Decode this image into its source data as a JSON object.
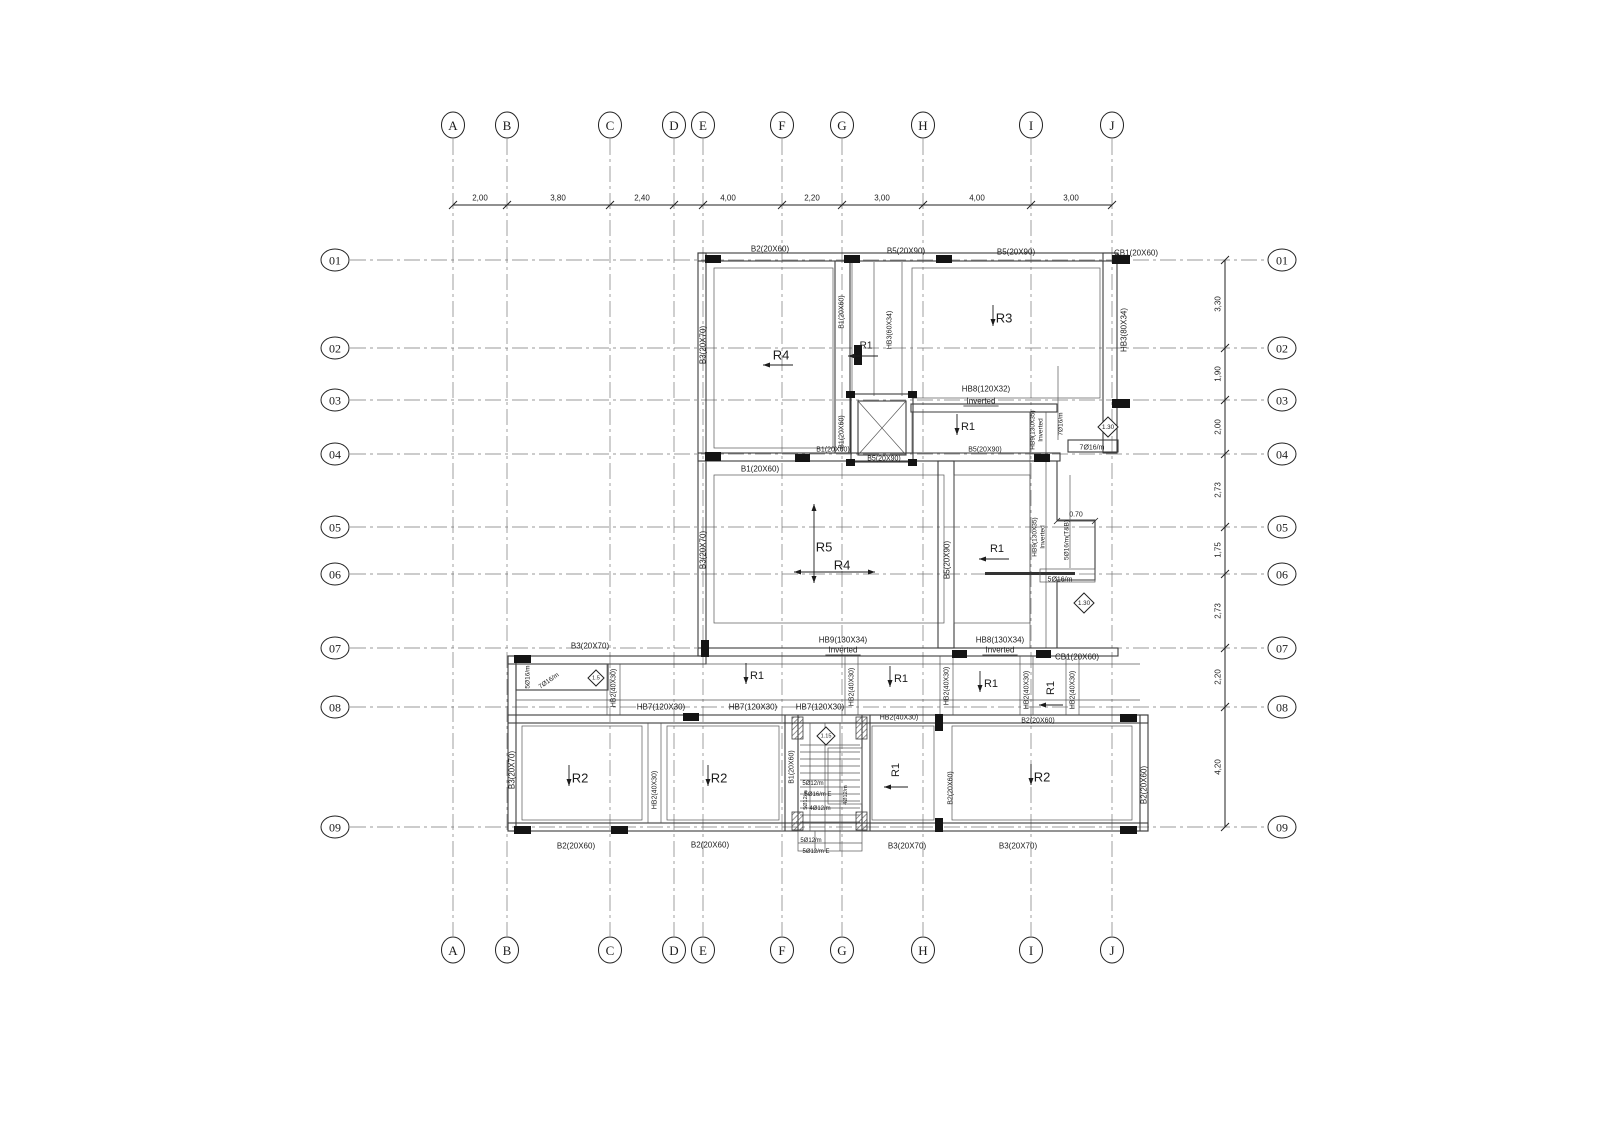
{
  "drawing": {
    "type": "structural-slab-beam-floor-plan",
    "bg_color": "#ffffff",
    "line_color": "#3d3d3d",
    "grid_color": "#6e6e6e"
  },
  "grid": {
    "columns": [
      {
        "label": "A",
        "x": 453
      },
      {
        "label": "B",
        "x": 507
      },
      {
        "label": "C",
        "x": 610
      },
      {
        "label": "D",
        "x": 674
      },
      {
        "label": "E",
        "x": 703
      },
      {
        "label": "F",
        "x": 782
      },
      {
        "label": "G",
        "x": 842
      },
      {
        "label": "H",
        "x": 923
      },
      {
        "label": "I",
        "x": 1031
      },
      {
        "label": "J",
        "x": 1112
      }
    ],
    "rows": [
      {
        "label": "01",
        "y": 260
      },
      {
        "label": "02",
        "y": 348
      },
      {
        "label": "03",
        "y": 400
      },
      {
        "label": "04",
        "y": 454
      },
      {
        "label": "05",
        "y": 527
      },
      {
        "label": "06",
        "y": 574
      },
      {
        "label": "07",
        "y": 648
      },
      {
        "label": "08",
        "y": 707
      },
      {
        "label": "09",
        "y": 827
      }
    ],
    "bubble_top_y": 125,
    "bubble_bottom_y": 950,
    "bubble_left_x": 335,
    "bubble_right_x": 1282,
    "vline_y1": 139,
    "vline_y2": 936,
    "hline_x1": 350,
    "hline_x2": 1268
  },
  "dimensions": {
    "top_line_y": 205,
    "right_line_x": 1225,
    "top": [
      {
        "t": "2,00",
        "x": 480
      },
      {
        "t": "3,80",
        "x": 558
      },
      {
        "t": "2,40",
        "x": 642
      },
      {
        "t": "4,00",
        "x": 728
      },
      {
        "t": "2,20",
        "x": 812
      },
      {
        "t": "3,00",
        "x": 882
      },
      {
        "t": "4,00",
        "x": 977
      },
      {
        "t": "3,00",
        "x": 1071
      }
    ],
    "right": [
      {
        "t": "3,30",
        "y": 304
      },
      {
        "t": "1,90",
        "y": 374
      },
      {
        "t": "2,00",
        "y": 427
      },
      {
        "t": "2,73",
        "y": 490
      },
      {
        "t": "1,75",
        "y": 550
      },
      {
        "t": "2,73",
        "y": 611
      },
      {
        "t": "2,20",
        "y": 677
      },
      {
        "t": "4,20",
        "y": 767
      }
    ],
    "small": [
      {
        "t": "0.70",
        "x1": 1057,
        "x2": 1095,
        "y": 521
      }
    ]
  },
  "labels": {
    "horizontal": [
      {
        "t": "B2(20X60)",
        "x": 770,
        "y": 249
      },
      {
        "t": "B5(20X90)",
        "x": 906,
        "y": 251
      },
      {
        "t": "B5(20X90)",
        "x": 1016,
        "y": 252
      },
      {
        "t": "CB1(20X60)",
        "x": 1136,
        "y": 253
      },
      {
        "t": "HB8(120X32)",
        "x": 986,
        "y": 389
      },
      {
        "t": "Inverted",
        "x": 981,
        "y": 401,
        "u": true
      },
      {
        "t": "B1(20X60)",
        "x": 833,
        "y": 450,
        "s": 7
      },
      {
        "t": "B5(20X90)",
        "x": 884,
        "y": 459,
        "s": 7
      },
      {
        "t": "B5(20X90)",
        "x": 985,
        "y": 450,
        "s": 7
      },
      {
        "t": "B1(20X60)",
        "x": 760,
        "y": 469
      },
      {
        "t": "7Ø16/m",
        "x": 1092,
        "y": 448,
        "s": 7
      },
      {
        "t": "5Ø16/m",
        "x": 1060,
        "y": 580,
        "s": 7
      },
      {
        "t": "HB9(130X34)",
        "x": 843,
        "y": 640
      },
      {
        "t": "Inverted",
        "x": 843,
        "y": 650,
        "u": true
      },
      {
        "t": "HB8(130X34)",
        "x": 1000,
        "y": 640
      },
      {
        "t": "Inverted",
        "x": 1000,
        "y": 650,
        "u": true
      },
      {
        "t": "CB1(20X60)",
        "x": 1077,
        "y": 657
      },
      {
        "t": "B3(20X70)",
        "x": 590,
        "y": 646
      },
      {
        "t": "HB7(120X30)",
        "x": 661,
        "y": 707
      },
      {
        "t": "HB7(120X30)",
        "x": 753,
        "y": 707
      },
      {
        "t": "HB7(120X30)",
        "x": 820,
        "y": 707
      },
      {
        "t": "HB2(40X30)",
        "x": 899,
        "y": 718,
        "s": 7
      },
      {
        "t": "B2(20X60)",
        "x": 1038,
        "y": 721,
        "s": 7
      },
      {
        "t": "B2(20X60)",
        "x": 576,
        "y": 846
      },
      {
        "t": "B2(20X60)",
        "x": 710,
        "y": 845
      },
      {
        "t": "B3(20X70)",
        "x": 907,
        "y": 846
      },
      {
        "t": "B3(20X70)",
        "x": 1018,
        "y": 846
      },
      {
        "t": "5Ø12/m",
        "x": 813,
        "y": 784,
        "s": 6
      },
      {
        "t": "5Ø16/m E",
        "x": 818,
        "y": 795,
        "s": 6
      },
      {
        "t": "4Ø12/m",
        "x": 820,
        "y": 809,
        "s": 6
      },
      {
        "t": "5Ø12/m",
        "x": 811,
        "y": 841,
        "s": 6
      },
      {
        "t": "5Ø12/m E",
        "x": 816,
        "y": 852,
        "s": 6
      }
    ],
    "vertical": [
      {
        "t": "B3(20X70)",
        "x": 703,
        "y": 345
      },
      {
        "t": "B3(20X70)",
        "x": 703,
        "y": 550
      },
      {
        "t": "B1(20X60)",
        "x": 842,
        "y": 312,
        "s": 7
      },
      {
        "t": "B1(20X60)",
        "x": 842,
        "y": 432,
        "s": 7
      },
      {
        "t": "HB3(60X34)",
        "x": 890,
        "y": 330,
        "s": 7
      },
      {
        "t": "HB3(80X34)",
        "x": 1124,
        "y": 330
      },
      {
        "t": "HB9(130X35)",
        "x": 1033,
        "y": 430,
        "s": 6.5
      },
      {
        "t": "Inverted",
        "x": 1041,
        "y": 430,
        "s": 6.5
      },
      {
        "t": "7Ø16/m",
        "x": 1061,
        "y": 424,
        "s": 6.5
      },
      {
        "t": "B5(20X90)",
        "x": 947,
        "y": 560
      },
      {
        "t": "HB9(130X35)",
        "x": 1035,
        "y": 537,
        "s": 6.5
      },
      {
        "t": "Inverted",
        "x": 1043,
        "y": 537,
        "s": 6.5
      },
      {
        "t": "5Ø16/m(T&B)",
        "x": 1067,
        "y": 540,
        "s": 6.5
      },
      {
        "t": "5Ø16/m",
        "x": 528,
        "y": 677,
        "s": 6.5
      },
      {
        "t": "HB2(40X30)",
        "x": 614,
        "y": 688,
        "s": 7
      },
      {
        "t": "HB2(40X30)",
        "x": 852,
        "y": 687,
        "s": 7
      },
      {
        "t": "HB2(40X30)",
        "x": 947,
        "y": 686,
        "s": 7
      },
      {
        "t": "HB2(40X30)",
        "x": 1027,
        "y": 690,
        "s": 7
      },
      {
        "t": "HB2(40X30)",
        "x": 1073,
        "y": 690,
        "s": 7
      },
      {
        "t": "B3(20X70)",
        "x": 512,
        "y": 770
      },
      {
        "t": "HB2(40X30)",
        "x": 655,
        "y": 790,
        "s": 7
      },
      {
        "t": "B1(20X60)",
        "x": 792,
        "y": 767,
        "s": 7
      },
      {
        "t": "B2(20X60)",
        "x": 951,
        "y": 788,
        "s": 7
      },
      {
        "t": "B2(20X60)",
        "x": 1144,
        "y": 785
      },
      {
        "t": "5Ø12/m",
        "x": 806,
        "y": 800,
        "s": 5.5
      },
      {
        "t": "4Ø12/m",
        "x": 846,
        "y": 795,
        "s": 5.5
      }
    ],
    "diagonal": [
      {
        "t": "7Ø16/m",
        "x": 549,
        "y": 681,
        "rot": -35,
        "s": 6.5
      }
    ]
  },
  "rooms": [
    {
      "n": "R4",
      "x": 781,
      "y": 355,
      "a": "left"
    },
    {
      "n": "R1",
      "x": 866,
      "y": 346,
      "a": "left",
      "s": 10
    },
    {
      "n": "R3",
      "x": 1004,
      "y": 318,
      "a": "down"
    },
    {
      "n": "R1",
      "x": 968,
      "y": 427,
      "a": "down",
      "s": 11
    },
    {
      "n": "R5",
      "x": 824,
      "y": 547,
      "a": "vlong"
    },
    {
      "n": "R4",
      "x": 842,
      "y": 565,
      "a": "hlong"
    },
    {
      "n": "R1",
      "x": 997,
      "y": 549,
      "a": "left",
      "s": 11
    },
    {
      "n": "R1",
      "x": 757,
      "y": 676,
      "a": "down",
      "s": 11
    },
    {
      "n": "R1",
      "x": 901,
      "y": 679,
      "a": "down",
      "s": 11
    },
    {
      "n": "R1",
      "x": 991,
      "y": 684,
      "a": "down",
      "s": 11
    },
    {
      "n": "R1",
      "x": 1051,
      "y": 688,
      "a": "left",
      "rot": -90,
      "s": 11
    },
    {
      "n": "R1",
      "x": 896,
      "y": 770,
      "a": "left",
      "rot": -90,
      "s": 11
    },
    {
      "n": "R2",
      "x": 580,
      "y": 778,
      "a": "down"
    },
    {
      "n": "R2",
      "x": 719,
      "y": 778,
      "a": "down"
    },
    {
      "n": "R2",
      "x": 1042,
      "y": 777,
      "a": "down"
    }
  ],
  "levels": [
    {
      "t": "1.30",
      "x": 1108,
      "y": 427,
      "h": 10
    },
    {
      "t": "1.30",
      "x": 1084,
      "y": 603,
      "h": 10
    },
    {
      "t": "1.5",
      "x": 596,
      "y": 678,
      "h": 8
    },
    {
      "t": "1.15",
      "x": 826,
      "y": 736,
      "h": 9
    }
  ]
}
